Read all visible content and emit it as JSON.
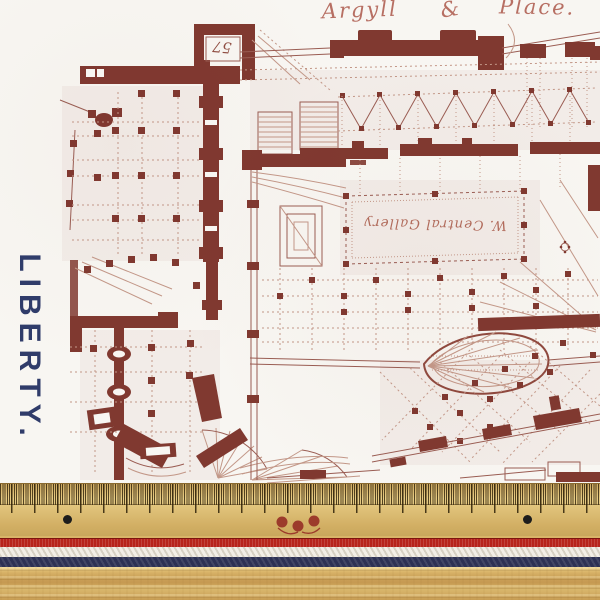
{
  "fabric": {
    "brand": "LIBERTY.",
    "print_color": "#7a2f26",
    "brand_color": "#303c6a",
    "background_color": "#f8f6f2",
    "plan_labels": {
      "street_left": "Argyll",
      "street_amp": "&",
      "street_right": "Place.",
      "room_number": "57",
      "gallery": "W. Central Gallery"
    }
  },
  "ruler": {
    "wood_color": "#d9b96f",
    "tick_color": "#2d2008",
    "black_dot_color": "#1c1c1c",
    "center_mark_color": "#9c3b2b"
  },
  "ribbon": {
    "red": "#b7241c",
    "white": "#f2eee6",
    "navy": "#2d3154"
  }
}
